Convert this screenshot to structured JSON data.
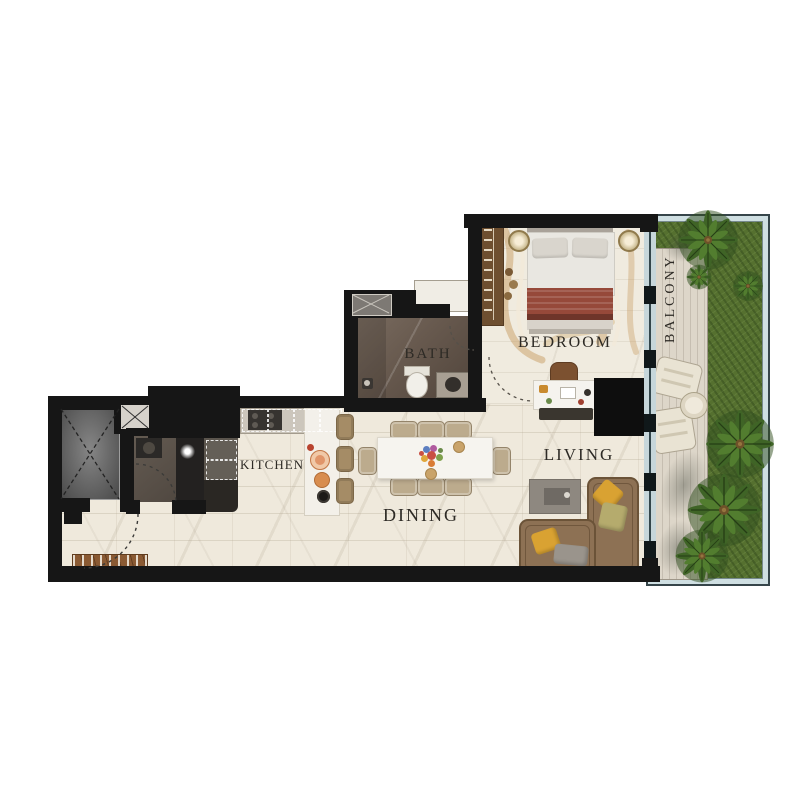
{
  "type": "apartment-floor-plan",
  "labels": {
    "bath": "BATH",
    "bedroom": "BEDROOM",
    "balcony": "BALCONY",
    "kitchen": "KITCHEN",
    "dining": "DINING",
    "living": "LIVING"
  },
  "palette": {
    "wall": "#161616",
    "floor": "#efe9dc",
    "bath_floor": "#675a4e",
    "deck": "#ddd6c9",
    "grass": "#55702f",
    "glass": "#cfdfe2",
    "sofa": "#8d7154",
    "pillow_yellow": "#d9a232",
    "pillow_olive": "#b5ab6d",
    "bed_blanket": "#96493a",
    "wood_bench": "#8a5a33",
    "chair_tan": "#bcab8d"
  }
}
